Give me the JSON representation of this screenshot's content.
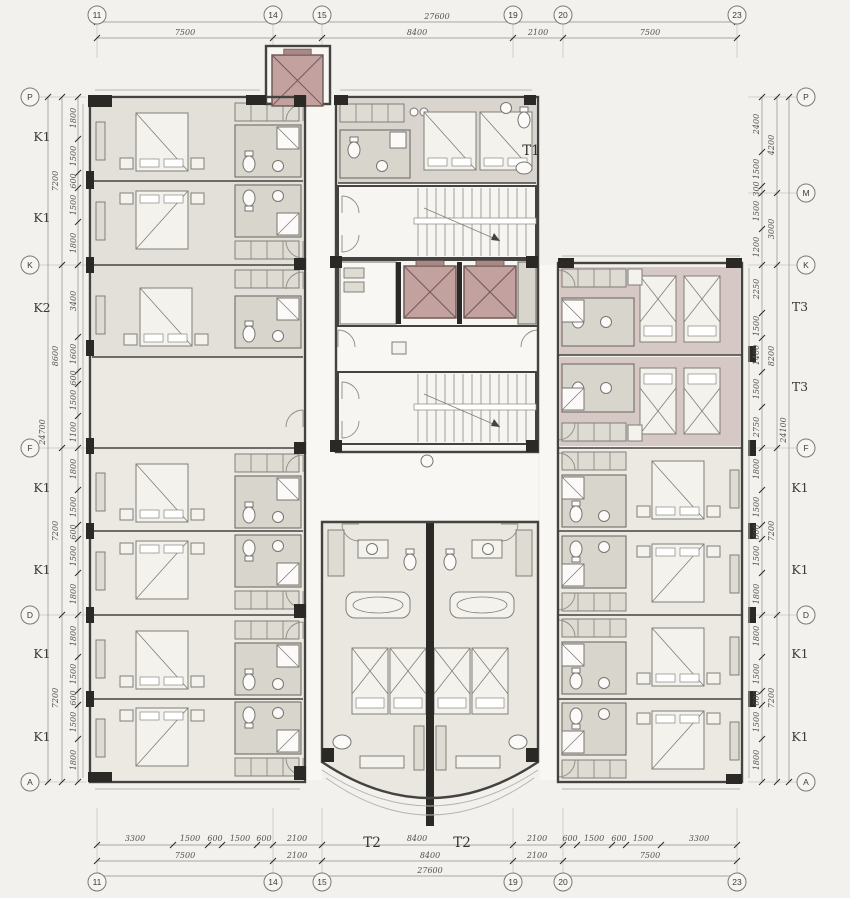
{
  "drawing": {
    "kind": "hotel guestroom floor plan",
    "colors": {
      "elevator_accent": "#c3a19f",
      "wall": "#45433f",
      "background": "#f2f1ed"
    }
  },
  "grid_markers": [
    {
      "label": "11",
      "x": 97,
      "y": 15
    },
    {
      "label": "14",
      "x": 273,
      "y": 15
    },
    {
      "label": "15",
      "x": 322,
      "y": 15
    },
    {
      "label": "19",
      "x": 513,
      "y": 15
    },
    {
      "label": "20",
      "x": 563,
      "y": 15
    },
    {
      "label": "23",
      "x": 737,
      "y": 15
    },
    {
      "label": "11",
      "x": 97,
      "y": 882
    },
    {
      "label": "14",
      "x": 273,
      "y": 882
    },
    {
      "label": "15",
      "x": 322,
      "y": 882
    },
    {
      "label": "19",
      "x": 513,
      "y": 882
    },
    {
      "label": "20",
      "x": 563,
      "y": 882
    },
    {
      "label": "23",
      "x": 737,
      "y": 882
    },
    {
      "label": "P",
      "x": 30,
      "y": 97
    },
    {
      "label": "K",
      "x": 30,
      "y": 265
    },
    {
      "label": "F",
      "x": 30,
      "y": 448
    },
    {
      "label": "D",
      "x": 30,
      "y": 615
    },
    {
      "label": "A",
      "x": 30,
      "y": 782
    },
    {
      "label": "P",
      "x": 806,
      "y": 97
    },
    {
      "label": "M",
      "x": 806,
      "y": 193
    },
    {
      "label": "K",
      "x": 806,
      "y": 265
    },
    {
      "label": "F",
      "x": 806,
      "y": 448
    },
    {
      "label": "D",
      "x": 806,
      "y": 615
    },
    {
      "label": "A",
      "x": 806,
      "y": 782
    }
  ],
  "annotations": [
    {
      "t": "27600",
      "x": 437,
      "y": 19,
      "c": "d"
    },
    {
      "t": "7500",
      "x": 185,
      "y": 35,
      "c": "d"
    },
    {
      "t": "8400",
      "x": 417,
      "y": 35,
      "c": "d"
    },
    {
      "t": "2100",
      "x": 538,
      "y": 35,
      "c": "d"
    },
    {
      "t": "7500",
      "x": 650,
      "y": 35,
      "c": "d"
    },
    {
      "t": "3300",
      "x": 135,
      "y": 841,
      "c": "d"
    },
    {
      "t": "1500",
      "x": 190,
      "y": 841,
      "c": "d"
    },
    {
      "t": "600",
      "x": 215,
      "y": 841,
      "c": "d"
    },
    {
      "t": "1500",
      "x": 240,
      "y": 841,
      "c": "d"
    },
    {
      "t": "600",
      "x": 264,
      "y": 841,
      "c": "d"
    },
    {
      "t": "2100",
      "x": 297,
      "y": 841,
      "c": "d"
    },
    {
      "t": "8400",
      "x": 417,
      "y": 841,
      "c": "d"
    },
    {
      "t": "2100",
      "x": 537,
      "y": 841,
      "c": "d"
    },
    {
      "t": "600",
      "x": 570,
      "y": 841,
      "c": "d"
    },
    {
      "t": "1500",
      "x": 594,
      "y": 841,
      "c": "d"
    },
    {
      "t": "600",
      "x": 619,
      "y": 841,
      "c": "d"
    },
    {
      "t": "1500",
      "x": 643,
      "y": 841,
      "c": "d"
    },
    {
      "t": "3300",
      "x": 699,
      "y": 841,
      "c": "d"
    },
    {
      "t": "7500",
      "x": 185,
      "y": 858,
      "c": "d"
    },
    {
      "t": "2100",
      "x": 297,
      "y": 858,
      "c": "d"
    },
    {
      "t": "8400",
      "x": 430,
      "y": 858,
      "c": "d"
    },
    {
      "t": "2100",
      "x": 537,
      "y": 858,
      "c": "d"
    },
    {
      "t": "7500",
      "x": 650,
      "y": 858,
      "c": "d"
    },
    {
      "t": "27600",
      "x": 430,
      "y": 873,
      "c": "d"
    },
    {
      "t": "T2",
      "x": 372,
      "y": 847,
      "c": "p"
    },
    {
      "t": "T2",
      "x": 462,
      "y": 847,
      "c": "p"
    },
    {
      "t": "T1",
      "x": 531,
      "y": 155,
      "c": "p"
    },
    {
      "t": "K1",
      "x": 42,
      "y": 141,
      "c": "u"
    },
    {
      "t": "K1",
      "x": 42,
      "y": 222,
      "c": "u"
    },
    {
      "t": "K2",
      "x": 42,
      "y": 312,
      "c": "u"
    },
    {
      "t": "K1",
      "x": 42,
      "y": 492,
      "c": "u"
    },
    {
      "t": "K1",
      "x": 42,
      "y": 574,
      "c": "u"
    },
    {
      "t": "K1",
      "x": 42,
      "y": 658,
      "c": "u"
    },
    {
      "t": "K1",
      "x": 42,
      "y": 741,
      "c": "u"
    },
    {
      "t": "7200",
      "x": 58,
      "y": 181,
      "c": "d",
      "r": 1
    },
    {
      "t": "8600",
      "x": 58,
      "y": 356,
      "c": "d",
      "r": 1
    },
    {
      "t": "7200",
      "x": 58,
      "y": 531,
      "c": "d",
      "r": 1
    },
    {
      "t": "7200",
      "x": 58,
      "y": 698,
      "c": "d",
      "r": 1
    },
    {
      "t": "24700",
      "x": 45,
      "y": 432,
      "c": "d",
      "r": 1
    },
    {
      "t": "1800",
      "x": 76,
      "y": 118,
      "c": "d",
      "r": 1
    },
    {
      "t": "1500",
      "x": 76,
      "y": 156,
      "c": "d",
      "r": 1
    },
    {
      "t": "600",
      "x": 76,
      "y": 181,
      "c": "d",
      "r": 1
    },
    {
      "t": "1500",
      "x": 76,
      "y": 205,
      "c": "d",
      "r": 1
    },
    {
      "t": "1800",
      "x": 76,
      "y": 243,
      "c": "d",
      "r": 1
    },
    {
      "t": "3400",
      "x": 76,
      "y": 301,
      "c": "d",
      "r": 1
    },
    {
      "t": "1600",
      "x": 76,
      "y": 354,
      "c": "d",
      "r": 1
    },
    {
      "t": "600",
      "x": 76,
      "y": 378,
      "c": "d",
      "r": 1
    },
    {
      "t": "1500",
      "x": 76,
      "y": 400,
      "c": "d",
      "r": 1
    },
    {
      "t": "1100",
      "x": 76,
      "y": 432,
      "c": "d",
      "r": 1
    },
    {
      "t": "1800",
      "x": 76,
      "y": 469,
      "c": "d",
      "r": 1
    },
    {
      "t": "1500",
      "x": 76,
      "y": 507,
      "c": "d",
      "r": 1
    },
    {
      "t": "600",
      "x": 76,
      "y": 532,
      "c": "d",
      "r": 1
    },
    {
      "t": "1500",
      "x": 76,
      "y": 556,
      "c": "d",
      "r": 1
    },
    {
      "t": "1800",
      "x": 76,
      "y": 594,
      "c": "d",
      "r": 1
    },
    {
      "t": "1800",
      "x": 76,
      "y": 636,
      "c": "d",
      "r": 1
    },
    {
      "t": "1500",
      "x": 76,
      "y": 674,
      "c": "d",
      "r": 1
    },
    {
      "t": "600",
      "x": 76,
      "y": 698,
      "c": "d",
      "r": 1
    },
    {
      "t": "1500",
      "x": 76,
      "y": 722,
      "c": "d",
      "r": 1
    },
    {
      "t": "1800",
      "x": 76,
      "y": 760,
      "c": "d",
      "r": 1
    },
    {
      "t": "2400",
      "x": 759,
      "y": 124,
      "c": "d",
      "r": 1
    },
    {
      "t": "1500",
      "x": 759,
      "y": 169,
      "c": "d",
      "r": 1
    },
    {
      "t": "300",
      "x": 759,
      "y": 189,
      "c": "d",
      "r": 1
    },
    {
      "t": "1500",
      "x": 759,
      "y": 211,
      "c": "d",
      "r": 1
    },
    {
      "t": "1200",
      "x": 759,
      "y": 247,
      "c": "d",
      "r": 1
    },
    {
      "t": "2250",
      "x": 759,
      "y": 289,
      "c": "d",
      "r": 1
    },
    {
      "t": "1500",
      "x": 759,
      "y": 326,
      "c": "d",
      "r": 1
    },
    {
      "t": "1400",
      "x": 759,
      "y": 355,
      "c": "d",
      "r": 1
    },
    {
      "t": "1500",
      "x": 759,
      "y": 389,
      "c": "d",
      "r": 1
    },
    {
      "t": "2750",
      "x": 759,
      "y": 427,
      "c": "d",
      "r": 1
    },
    {
      "t": "1800",
      "x": 759,
      "y": 469,
      "c": "d",
      "r": 1
    },
    {
      "t": "1500",
      "x": 759,
      "y": 507,
      "c": "d",
      "r": 1
    },
    {
      "t": "600",
      "x": 759,
      "y": 532,
      "c": "d",
      "r": 1
    },
    {
      "t": "1500",
      "x": 759,
      "y": 556,
      "c": "d",
      "r": 1
    },
    {
      "t": "1800",
      "x": 759,
      "y": 594,
      "c": "d",
      "r": 1
    },
    {
      "t": "1800",
      "x": 759,
      "y": 636,
      "c": "d",
      "r": 1
    },
    {
      "t": "1500",
      "x": 759,
      "y": 674,
      "c": "d",
      "r": 1
    },
    {
      "t": "600",
      "x": 759,
      "y": 698,
      "c": "d",
      "r": 1
    },
    {
      "t": "1500",
      "x": 759,
      "y": 722,
      "c": "d",
      "r": 1
    },
    {
      "t": "1800",
      "x": 759,
      "y": 760,
      "c": "d",
      "r": 1
    },
    {
      "t": "4200",
      "x": 774,
      "y": 145,
      "c": "d",
      "r": 1
    },
    {
      "t": "3000",
      "x": 774,
      "y": 229,
      "c": "d",
      "r": 1
    },
    {
      "t": "8200",
      "x": 774,
      "y": 356,
      "c": "d",
      "r": 1
    },
    {
      "t": "7200",
      "x": 774,
      "y": 531,
      "c": "d",
      "r": 1
    },
    {
      "t": "7200",
      "x": 774,
      "y": 698,
      "c": "d",
      "r": 1
    },
    {
      "t": "24100",
      "x": 786,
      "y": 430,
      "c": "d",
      "r": 1
    },
    {
      "t": "T3",
      "x": 800,
      "y": 311,
      "c": "u"
    },
    {
      "t": "T3",
      "x": 800,
      "y": 391,
      "c": "u"
    },
    {
      "t": "K1",
      "x": 800,
      "y": 492,
      "c": "u"
    },
    {
      "t": "K1",
      "x": 800,
      "y": 574,
      "c": "u"
    },
    {
      "t": "K1",
      "x": 800,
      "y": 658,
      "c": "u"
    },
    {
      "t": "K1",
      "x": 800,
      "y": 741,
      "c": "u"
    }
  ],
  "dim_lines": [
    {
      "x1": 97,
      "y1": 22,
      "x2": 737,
      "y2": 22,
      "ticks": [
        97,
        737
      ]
    },
    {
      "x1": 97,
      "y1": 38,
      "x2": 737,
      "y2": 38,
      "ticks": [
        97,
        273,
        322,
        513,
        563,
        737
      ]
    },
    {
      "x1": 97,
      "y1": 845,
      "x2": 737,
      "y2": 845,
      "ticks": [
        97,
        173,
        208,
        222,
        257,
        273,
        322,
        513,
        563,
        577,
        612,
        626,
        661,
        737
      ]
    },
    {
      "x1": 97,
      "y1": 861,
      "x2": 737,
      "y2": 861,
      "ticks": [
        97,
        273,
        322,
        513,
        563,
        737
      ]
    },
    {
      "x1": 97,
      "y1": 876,
      "x2": 737,
      "y2": 876,
      "ticks": [
        97,
        737
      ]
    },
    {
      "x1": 48,
      "y1": 97,
      "x2": 48,
      "y2": 782,
      "ticks": [
        97,
        782
      ]
    },
    {
      "x1": 62,
      "y1": 97,
      "x2": 62,
      "y2": 782,
      "ticks": [
        97,
        265,
        448,
        615,
        782
      ]
    },
    {
      "x1": 78,
      "y1": 97,
      "x2": 78,
      "y2": 782,
      "ticks": [
        97,
        139,
        173,
        188,
        222,
        265,
        337,
        371,
        384,
        416,
        448,
        490,
        525,
        539,
        573,
        615,
        657,
        691,
        705,
        739,
        782
      ]
    },
    {
      "x1": 762,
      "y1": 97,
      "x2": 762,
      "y2": 782,
      "ticks": [
        97,
        152,
        186,
        193,
        229,
        265,
        313,
        338,
        372,
        407,
        448,
        490,
        525,
        539,
        573,
        615,
        657,
        691,
        705,
        739,
        782
      ]
    },
    {
      "x1": 777,
      "y1": 97,
      "x2": 777,
      "y2": 782,
      "ticks": [
        97,
        193,
        265,
        448,
        615,
        782
      ]
    },
    {
      "x1": 789,
      "y1": 97,
      "x2": 789,
      "y2": 782,
      "ticks": [
        97,
        782
      ]
    }
  ]
}
